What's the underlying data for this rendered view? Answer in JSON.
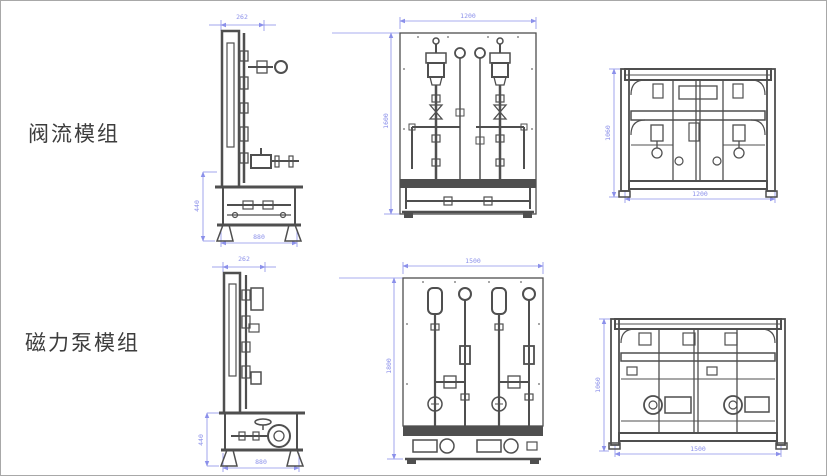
{
  "page": {
    "background": "#ffffff",
    "border_color": "#a8a8a8"
  },
  "colors": {
    "line_art": "#4f4f4f",
    "dimension": "#8b90ea",
    "label_text": "#3d3d3d"
  },
  "rows": [
    {
      "label": "阀流模组",
      "views": [
        {
          "name": "side-view",
          "dims": {
            "top": "262",
            "left": "440",
            "bottom": "880"
          }
        },
        {
          "name": "front-view",
          "dims": {
            "top": "1200",
            "left": "1600"
          }
        },
        {
          "name": "rear-view",
          "dims": {
            "left": "1060",
            "bottom": "1200"
          }
        }
      ]
    },
    {
      "label": "磁力泵模组",
      "views": [
        {
          "name": "side-view",
          "dims": {
            "top": "262",
            "left": "440",
            "bottom": "880"
          }
        },
        {
          "name": "front-view",
          "dims": {
            "top": "1500",
            "left": "1800"
          }
        },
        {
          "name": "rear-view",
          "dims": {
            "left": "1060",
            "bottom": "1500"
          }
        }
      ]
    }
  ]
}
